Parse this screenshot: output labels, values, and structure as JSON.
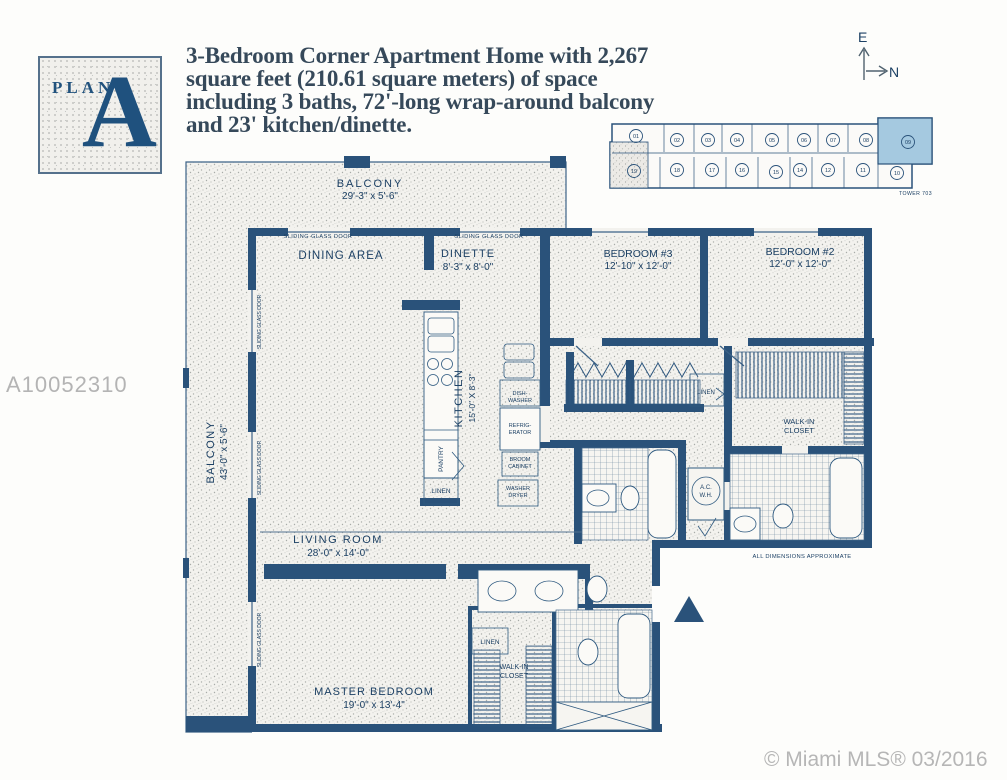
{
  "plan_badge": {
    "word": "PLAN",
    "letter": "A"
  },
  "header": {
    "lines": [
      "3-Bedroom Corner Apartment Home with 2,267",
      "square feet (210.61 square meters) of space",
      "including 3 baths, 72'-long wrap-around balcony",
      "and 23' kitchen/dinette."
    ]
  },
  "compass": {
    "east": "E",
    "north": "N"
  },
  "keyplan": {
    "tower_label": "TOWER 703",
    "top_units": [
      "01",
      "02",
      "03",
      "04",
      "05",
      "06",
      "07",
      "08",
      "09"
    ],
    "bottom_units": [
      "19",
      "18",
      "17",
      "16",
      "15",
      "14",
      "12",
      "11",
      "10"
    ],
    "highlighted_unit": "09",
    "highlight_color": "#a5c9e0"
  },
  "watermark": "A10052310",
  "copyright": "© Miami MLS® 03/2016",
  "floorplan": {
    "colors": {
      "wall_navy": "#2a527a",
      "label_blue": "#1c4064"
    },
    "rooms": {
      "balconyTop": {
        "name": "BALCONY",
        "dims": "29'-3\" x 5'-6\""
      },
      "balconyLeft": {
        "name": "BALCONY",
        "dims": "43'-0\" x 5'-6\""
      },
      "dining": {
        "name": "DINING AREA"
      },
      "dinette": {
        "name": "DINETTE",
        "dims": "8'-3\" x 8'-0\""
      },
      "bedroom3": {
        "name": "BEDROOM #3",
        "dims": "12'-10\" x 12'-0\""
      },
      "bedroom2": {
        "name": "BEDROOM #2",
        "dims": "12'-0\" x 12'-0\""
      },
      "kitchen": {
        "name": "KITCHEN",
        "dims": "15'-0\" X 8'-3\""
      },
      "living": {
        "name": "LIVING ROOM",
        "dims": "28'-0\" x 14'-0\""
      },
      "master": {
        "name": "MASTER BEDROOM",
        "dims": "19'-0\" x 13'-4\""
      }
    },
    "labels": {
      "sliding_glass_door": "SLIDING GLASS DOOR",
      "linen": "LINEN",
      "pantry": "PANTRY",
      "walkin_l1": "WALK-IN",
      "walkin_l2": "CLOSET",
      "dish_l1": "DISH-",
      "dish_l2": "WASHER",
      "refrig_l1": "REFRIG-",
      "refrig_l2": "ERATOR",
      "broom_l1": "BROOM",
      "broom_l2": "CABINET",
      "washer_l1": "WASHER",
      "washer_l2": "DRYER",
      "ac_l1": "A.C.",
      "ac_l2": "W.H.",
      "dimensions_note": "ALL DIMENSIONS APPROXIMATE"
    }
  }
}
